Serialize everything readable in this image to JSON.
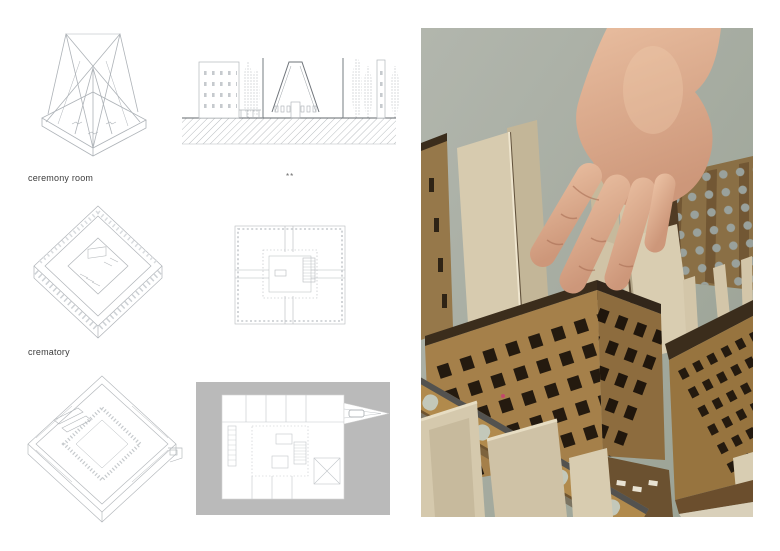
{
  "page": {
    "background": "#ffffff"
  },
  "board": {
    "label_ceremony_room": "ceremony room",
    "label_crematory": "crematory",
    "separator_mark": "**"
  },
  "figures": {
    "roof_axonometric": "roof structure axonometric drawing",
    "site_section": "site section drawing with chapel and trees",
    "ceremony_room_axonometric": "ceremony room cutaway axonometric drawing",
    "ceremony_room_plan": "ceremony room floor plan drawing",
    "crematory_axonometric": "crematory cutaway axonometric drawing",
    "crematory_site_plan": "crematory site plan drawing with entrance ramp",
    "model_photo": "photo of hand placing roof fins into laser-cut wooden model"
  },
  "palette": {
    "page-bg": "#ffffff",
    "drawing-line": "#aeb3b8",
    "drawing-dark": "#63686d",
    "site-gray": "#bababa",
    "photo-bg-top": "#b2b6ad",
    "photo-bg-bottom": "#99a193",
    "wood": "#a5804a",
    "wood-dark": "#8d6c3e",
    "wood-deep": "#6b5130",
    "burnt-edge": "#3b2d1c",
    "window": "#241a0f",
    "cardboard": "#d5c9ad",
    "cardboard-shade": "#c3b698",
    "skin": "#dfb094",
    "skin-shadow": "#bb8166",
    "accent-speck": "#c2496b"
  }
}
